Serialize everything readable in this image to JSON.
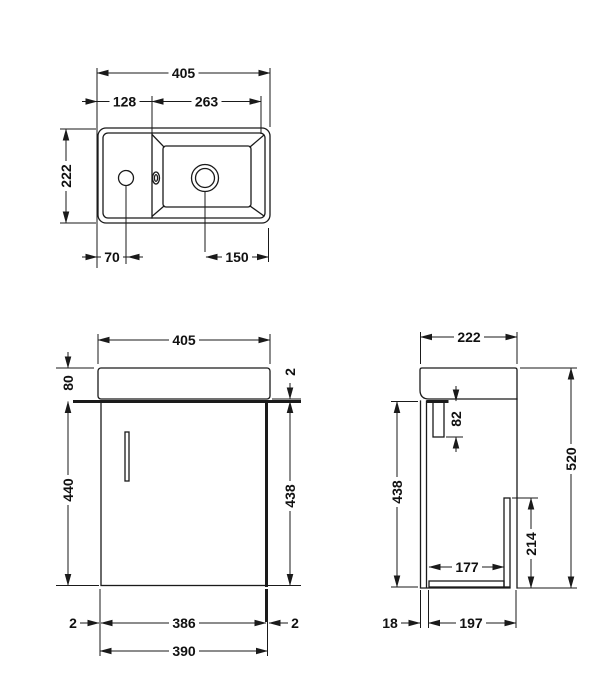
{
  "colors": {
    "line": "#1a1a1a",
    "background": "#ffffff"
  },
  "plan": {
    "overall_width": "405",
    "left_section": "128",
    "bowl_width": "263",
    "overall_depth": "222",
    "tap_hole_from_left": "70",
    "waste_from_right": "150"
  },
  "front": {
    "overall_width": "405",
    "basin_height": "80",
    "cabinet_height": "440",
    "door_top_gap": "2",
    "door_height": "438",
    "left_gap": "2",
    "door_width": "386",
    "right_gap": "2",
    "cabinet_width": "390"
  },
  "side": {
    "overall_depth": "222",
    "rail_drop": "82",
    "door_height": "438",
    "overall_height": "520",
    "back_panel_height": "214",
    "internal_depth": "177",
    "door_thickness": "18",
    "carcass_depth": "197"
  }
}
